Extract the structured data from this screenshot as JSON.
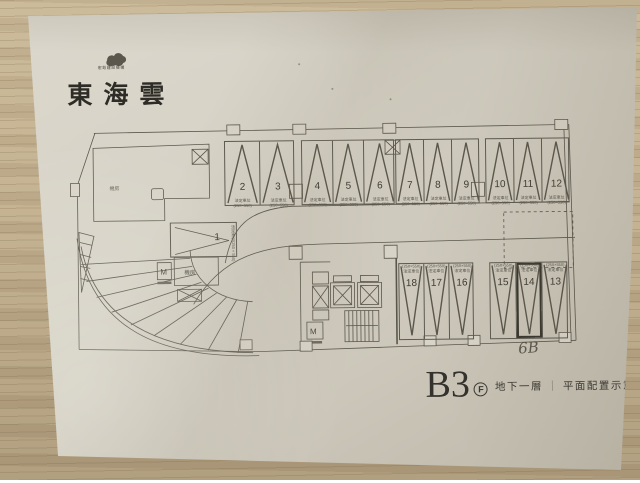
{
  "brand": {
    "logo_icon": "cloud-logo",
    "subtext": "宏銓建設機構",
    "title": "東海雲"
  },
  "plan": {
    "stall_note_type": "法定車位",
    "stall_note_size": "(250×550)",
    "rows": {
      "top_groups": [
        {
          "stalls": [
            "2",
            "3"
          ]
        },
        {
          "stalls": [
            "4",
            "5",
            "6"
          ]
        },
        {
          "stalls": [
            "7",
            "8",
            "9"
          ]
        },
        {
          "stalls": [
            "10",
            "11",
            "12"
          ]
        }
      ],
      "bottom_groups": [
        {
          "stalls": [
            "18",
            "17",
            "16"
          ]
        },
        {
          "stalls": [
            "15",
            "14",
            "13"
          ]
        }
      ]
    },
    "side_stall": {
      "number": "1",
      "note": "法定車位(250×550)"
    },
    "highlighted_stall": "14",
    "labels": {
      "elevator": "M",
      "machine_room": "機房"
    }
  },
  "annotations": {
    "handwritten": "6B"
  },
  "title_block": {
    "level_code": "B3",
    "floor_badge_letter": "F",
    "floor_label": "地下一層",
    "separator": "｜",
    "drawing_type": "平面配置示意圖"
  },
  "colors": {
    "paper": "#d6d1c5",
    "wood": "#c0ae8f",
    "ink": "#5a564b",
    "text_dark": "#34322c"
  }
}
